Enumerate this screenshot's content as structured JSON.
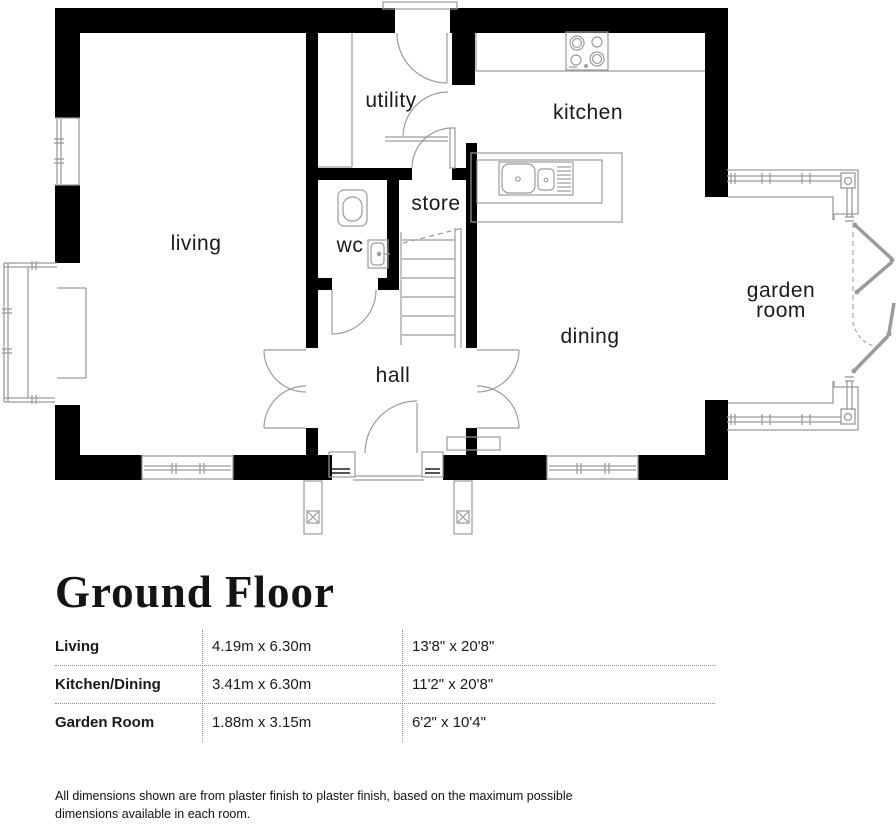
{
  "colors": {
    "wall": "#000000",
    "line": "#9b9b9b",
    "text": "#1a1a1a"
  },
  "plan": {
    "labels": {
      "living": "living",
      "utility": "utility",
      "kitchen": "kitchen",
      "store": "store",
      "wc": "wc",
      "hall": "hall",
      "dining": "dining",
      "garden_line1": "garden",
      "garden_line2": "room"
    }
  },
  "title": "Ground Floor",
  "table": {
    "rows": [
      {
        "name": "Living",
        "metric": "4.19m x 6.30m",
        "imperial": "13'8\" x 20'8\""
      },
      {
        "name": "Kitchen/Dining",
        "metric": "3.41m x 6.30m",
        "imperial": "11'2\" x 20'8\""
      },
      {
        "name": "Garden Room",
        "metric": "1.88m x 3.15m",
        "imperial": "6'2\" x 10'4\""
      }
    ]
  },
  "footnote": {
    "line1": "All dimensions shown are from plaster finish to plaster finish, based on the maximum possible",
    "line2": "dimensions available in each room."
  }
}
